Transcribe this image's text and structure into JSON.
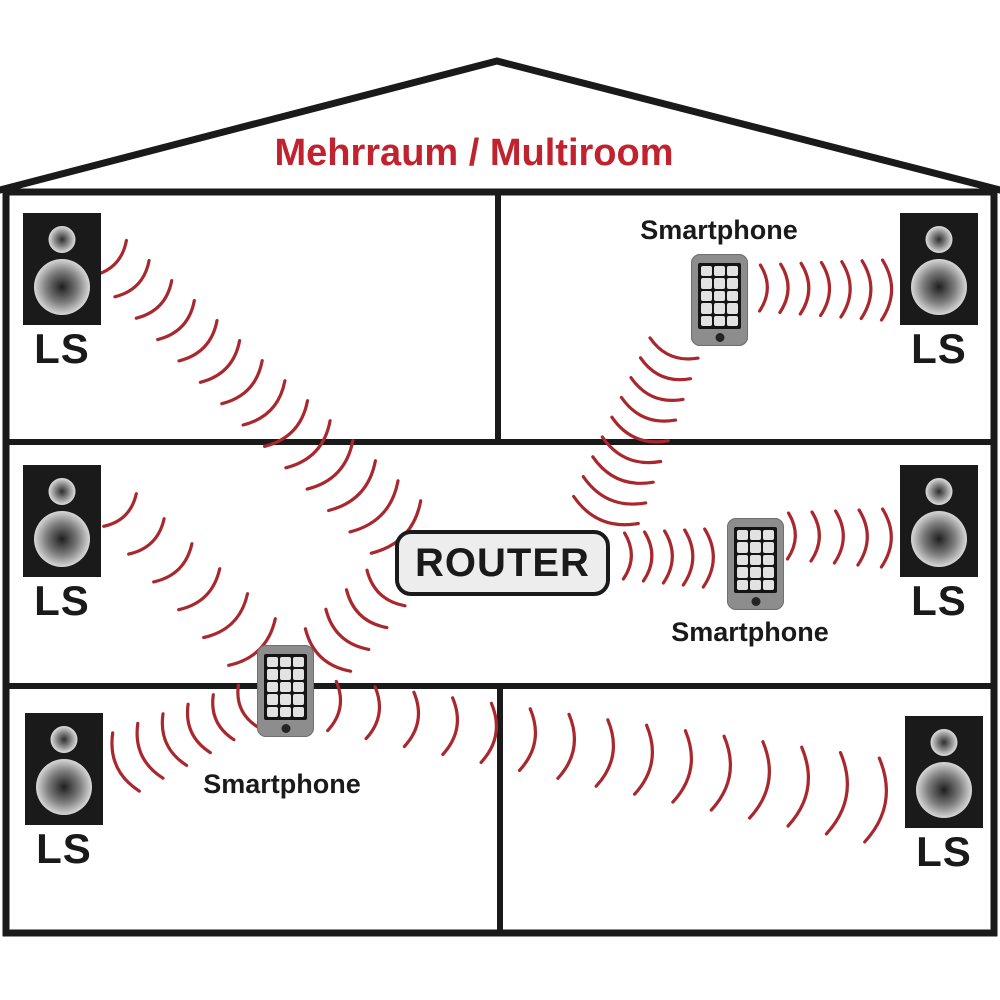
{
  "title": {
    "text": "Mehrraum / Multiroom"
  },
  "router": {
    "label": "ROUTER"
  },
  "colors": {
    "title": "#c0222e",
    "wave": "#a8282d",
    "wall": "#1a1a1a",
    "router_bg": "#ededed",
    "speaker_body": "#1a1a1a",
    "phone_body": "#8d8d8d",
    "phone_screen": "#141414",
    "phone_key": "#e2e2e2"
  },
  "speakers": [
    {
      "id": "top-left",
      "label": "LS",
      "x": 23,
      "y": 213
    },
    {
      "id": "top-right",
      "label": "LS",
      "x": 900,
      "y": 213
    },
    {
      "id": "middle-left",
      "label": "LS",
      "x": 23,
      "y": 465
    },
    {
      "id": "middle-right",
      "label": "LS",
      "x": 900,
      "y": 465
    },
    {
      "id": "bottom-left",
      "label": "LS",
      "x": 25,
      "y": 713
    },
    {
      "id": "bottom-right",
      "label": "LS",
      "x": 905,
      "y": 716
    }
  ],
  "phones": [
    {
      "id": "top-right-room",
      "label": "Smartphone",
      "x": 691,
      "y": 254,
      "label_x": 719,
      "label_y": 216
    },
    {
      "id": "middle-room",
      "label": "Smartphone",
      "x": 727,
      "y": 518,
      "label_x": 750,
      "label_y": 618
    },
    {
      "id": "hallway",
      "label": "Smartphone",
      "x": 257,
      "y": 645,
      "label_x": 282,
      "label_y": 770
    }
  ],
  "waves": [
    {
      "from": "speaker-top-left",
      "to": "router",
      "a": [
        110,
        258
      ],
      "b": [
        396,
        527
      ],
      "count": 14,
      "chord": [
        48,
        72
      ]
    },
    {
      "from": "phone-top-right",
      "to": "speaker-top-right",
      "a": [
        760,
        288
      ],
      "b": [
        882,
        290
      ],
      "count": 7,
      "chord": [
        46,
        60
      ]
    },
    {
      "from": "phone-top-right",
      "to": "router",
      "a": [
        674,
        348
      ],
      "b": [
        606,
        510
      ],
      "count": 9,
      "chord": [
        52,
        70
      ]
    },
    {
      "from": "speaker-middle-left",
      "to": "phone-hallway",
      "a": [
        120,
        510
      ],
      "b": [
        252,
        642
      ],
      "count": 6,
      "chord": [
        46,
        66
      ]
    },
    {
      "from": "router",
      "to": "phone-middle-room",
      "a": [
        624,
        556
      ],
      "b": [
        704,
        558
      ],
      "count": 5,
      "chord": [
        46,
        58
      ]
    },
    {
      "from": "phone-middle-room",
      "to": "speaker-middle-right",
      "a": [
        788,
        536
      ],
      "b": [
        882,
        538
      ],
      "count": 5,
      "chord": [
        46,
        58
      ]
    },
    {
      "from": "router",
      "to": "phone-hallway",
      "a": [
        386,
        588
      ],
      "b": [
        328,
        650
      ],
      "count": 4,
      "chord": [
        52,
        62
      ]
    },
    {
      "from": "phone-hallway",
      "to": "speaker-bottom-left",
      "a": [
        248,
        706
      ],
      "b": [
        126,
        762
      ],
      "count": 6,
      "chord": [
        46,
        64
      ]
    },
    {
      "from": "phone-hallway",
      "to": "speaker-bottom-right",
      "a": [
        332,
        706
      ],
      "b": [
        872,
        800
      ],
      "count": 15,
      "chord": [
        50,
        85
      ]
    }
  ]
}
